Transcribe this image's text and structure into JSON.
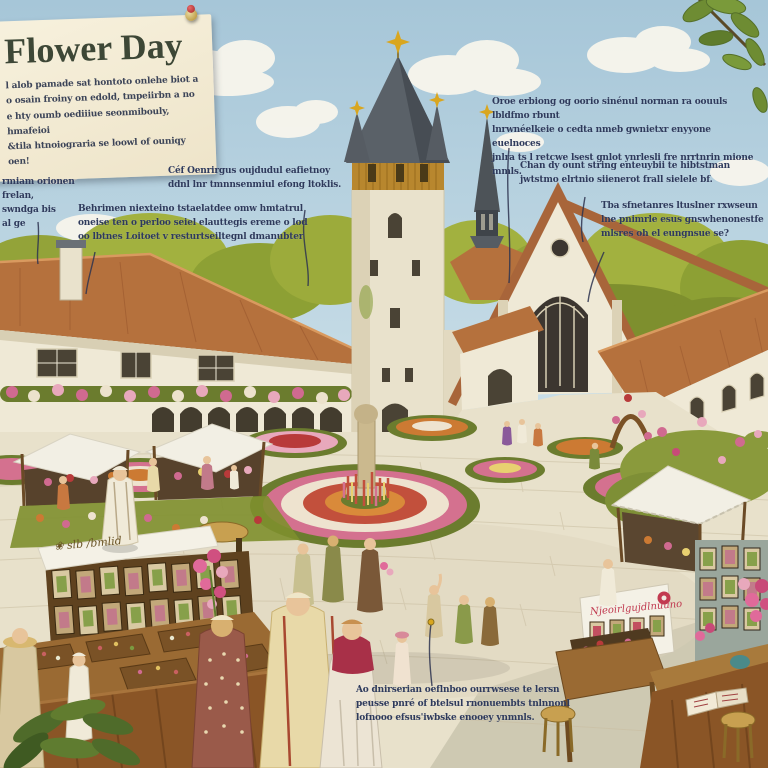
{
  "title_card": {
    "title": "Flower Day",
    "body": "l alob pamade sat hontoto onlehe biot a\no osain froiny on edold, tmpeiirbn a no\ne hty oumb oediiiue seonmibouly, hmafeioi\n&tila htnoiograria se loowl of ouniqy oen!"
  },
  "annotations": {
    "left_sky": "rmiam orionen frelan,\nswndga bis\nal ge",
    "beverages": "Céf Oenrirgus oujdudul eafietnoy\nddnl lnr tmnnsenmiul efong ltoklis.",
    "behirnen": "Behrimen niexteino tstaelatdee omw hmtatrul\noneise ten o perloo seiel elauttegis ereme o lod\noo lbtnes Loitoet v resturtseiltegnl dmanubter",
    "top_right": "Oroe erbiong og oorio sinénul norman ra oouuls lbldfmo rbunt\nlnrwnéelkeie o cedta nmeb gwnietxr enyyone euelnoces\njnlra ts l retcwe lsest gnlot ynrlesli fre nrrtnrin mione mmls.",
    "chan_dy": "Chan dy ount string enteuybii te hibtstman\njwtstmo elrtnio siienerot frall sielele bf.",
    "right_far": "Tba sfnetanres ltuslner rxwseun\nlne pnimrle esus gnswhenonestfe\nmlsres oh el eungnsue se?",
    "bottom_center": "Ao dnirserian oeflnboo ourrwsese te lersn\npeusse pnré of btelsul rnonuembts tnlnnonl\nlofnooo efsus'iwbske enooey ynmnls."
  },
  "signs": {
    "left_stall": "❀ slb /bmlid",
    "right_stall": "Njeoirlgujdlnuuno"
  },
  "palette": {
    "sky_top": "#a6c6d8",
    "sky_bottom": "#cfe2ea",
    "roof": "#b5713d",
    "wall": "#efe9d6",
    "spire": "#5a6168",
    "paving": "#e8e1cb",
    "annotation_text": "#2e3a5c",
    "accent_pink": "#d06a90",
    "accent_red": "#b83a3a",
    "gold": "#d9a61f"
  }
}
